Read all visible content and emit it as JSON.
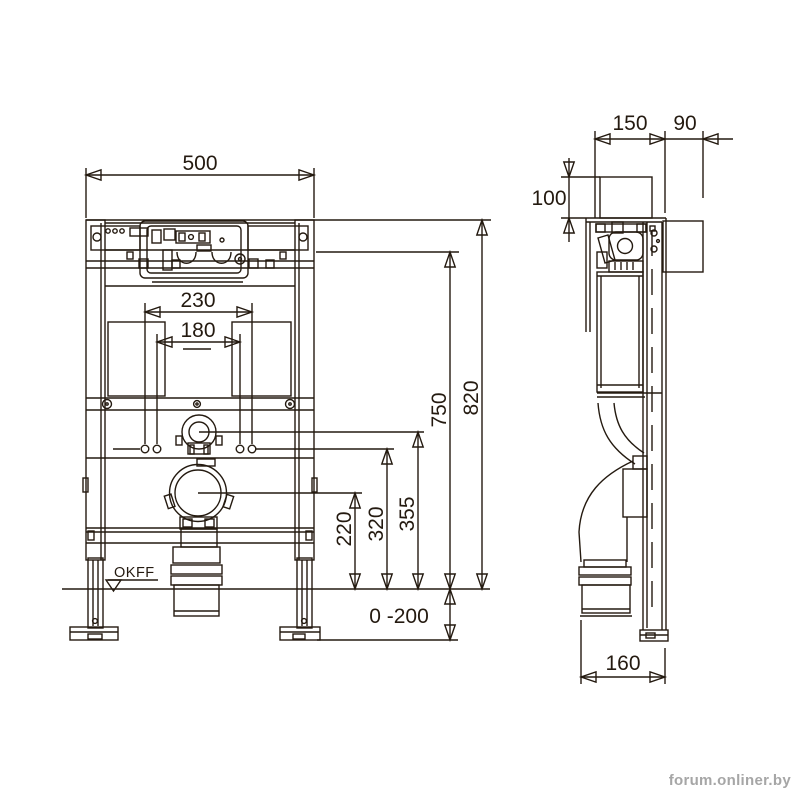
{
  "colors": {
    "ink": "#241a10",
    "background": "#ffffff",
    "watermark_text": "#a6a6a6"
  },
  "watermark": "forum.onliner.by",
  "front_view": {
    "dim_overall_width": "500",
    "dim_fixing_outer": "230",
    "dim_fixing_inner": "180",
    "dim_overall_height": "820",
    "dim_upper_fixing_height": "750",
    "dim_flush_pipe_center": "355",
    "dim_fixing_bolt_height": "320",
    "dim_outlet_center": "220",
    "dim_foot_adjustment": "0 -200",
    "floor_level_label": "OKFF"
  },
  "side_view": {
    "dim_frame_depth": "150",
    "dim_rear_clearance": "90",
    "dim_plate_shaft_height": "100",
    "dim_outlet_offset": "160"
  }
}
